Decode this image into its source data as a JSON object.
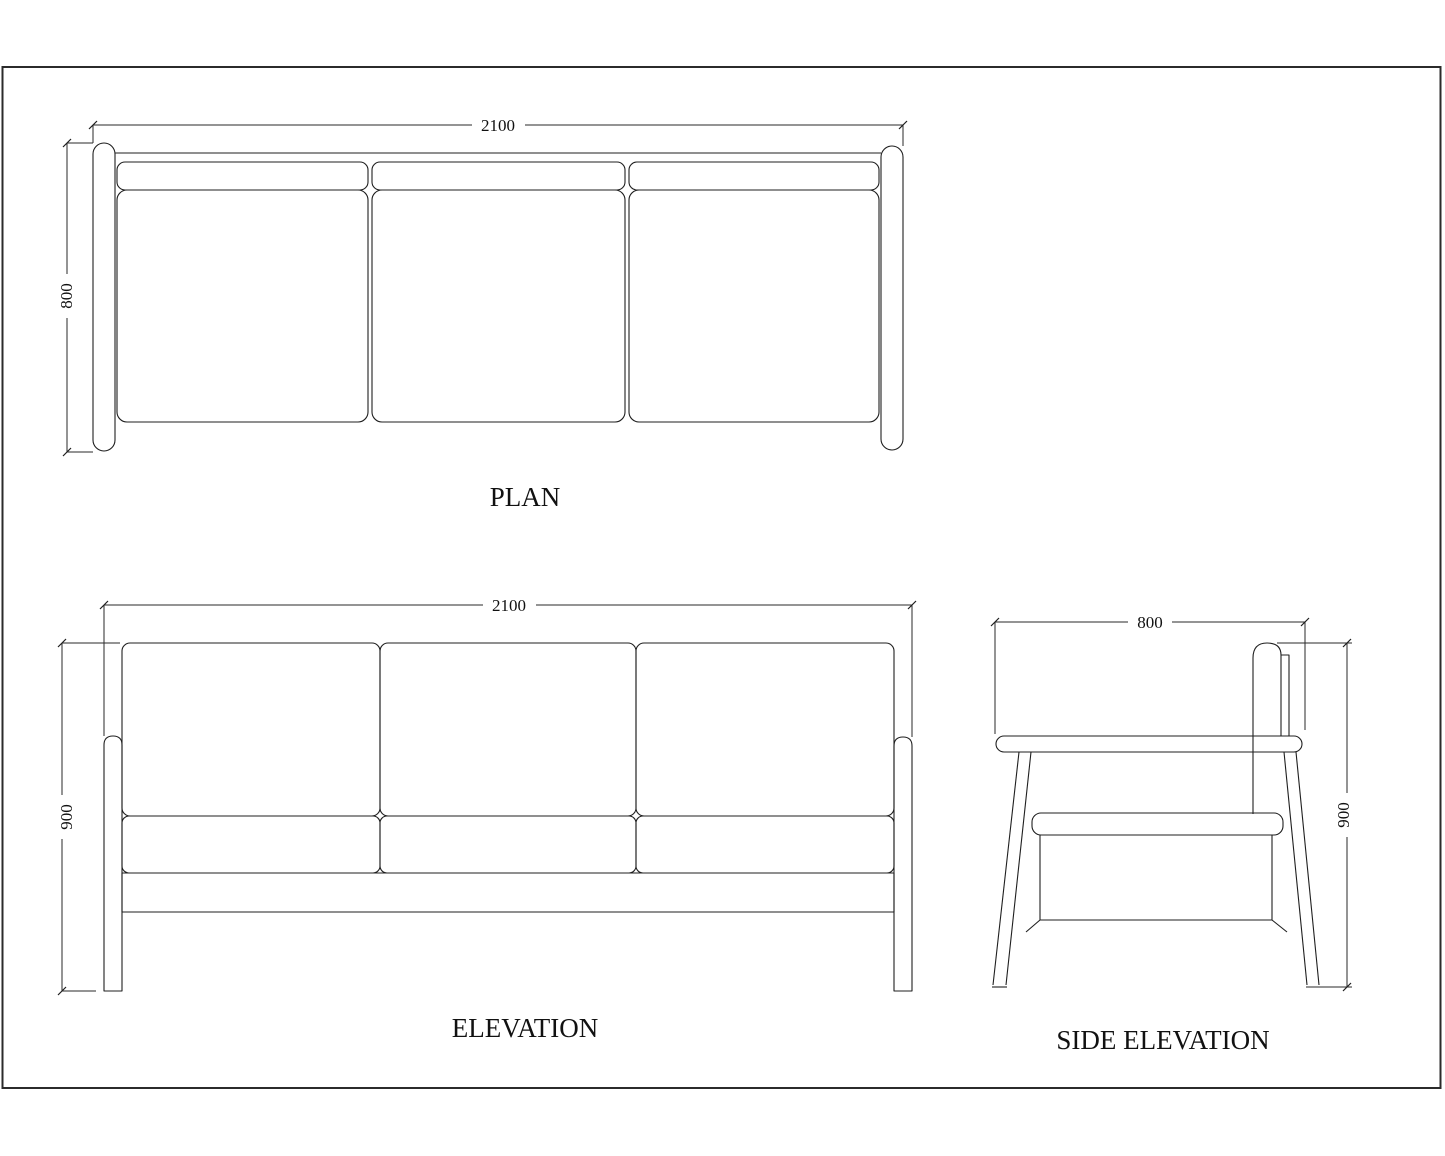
{
  "sheet": {
    "background_color": "#ffffff",
    "line_color": "#1f1f1f"
  },
  "views": {
    "plan": {
      "title": "PLAN",
      "dim_width": "2100",
      "dim_depth": "800"
    },
    "elevation": {
      "title": "ELEVATION",
      "dim_width": "2100",
      "dim_height": "900"
    },
    "side_elevation": {
      "title": "SIDE ELEVATION",
      "dim_depth": "800",
      "dim_height": "900"
    }
  }
}
